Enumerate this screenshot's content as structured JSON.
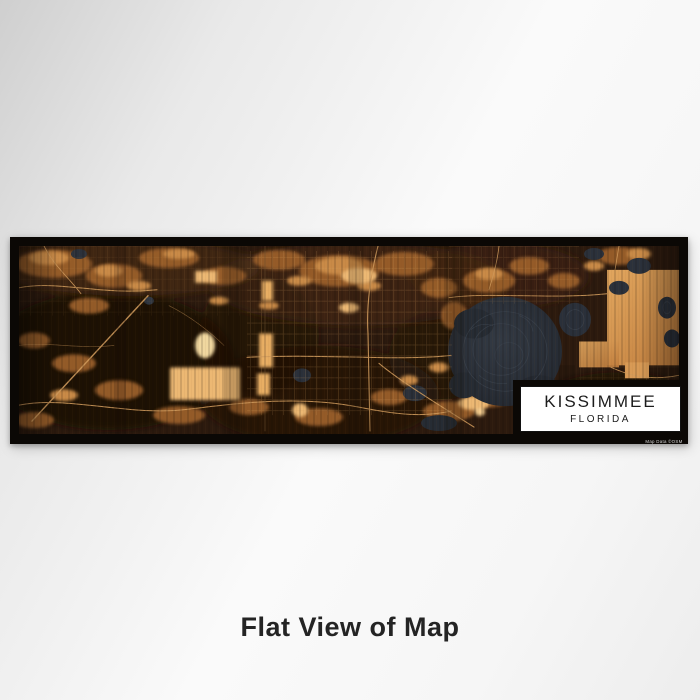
{
  "caption": "Flat View of Map",
  "label": {
    "title": "KISSIMMEE",
    "subtitle": "FLORIDA",
    "credit": "Map Data ©OSM"
  },
  "map": {
    "colors": {
      "frame": "#0b0805",
      "map_base": "#2c1a0e",
      "amber_mid": "#9a5f2c",
      "amber_bright": "#ecb873",
      "road": "#cf9a5c",
      "water": "#262c34",
      "label_background": "#ffffff",
      "label_text": "#1c1c1c",
      "backdrop": "#e9e9e9"
    }
  }
}
